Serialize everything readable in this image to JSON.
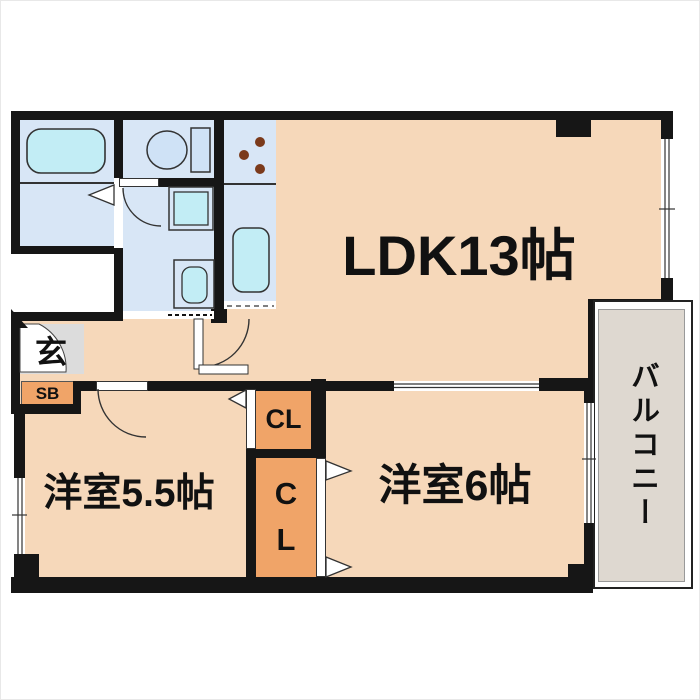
{
  "rooms": {
    "ldk": {
      "label": "LDK13帖"
    },
    "western_room_5_5": {
      "label": "洋室5.5帖"
    },
    "western_room_6": {
      "label": "洋室6帖"
    },
    "balcony": {
      "label": "バルコニー"
    },
    "entrance": {
      "label": "玄"
    },
    "shoe_box": {
      "label": "SB"
    },
    "closet_upper": {
      "label": "CL"
    },
    "closet_lower": {
      "letters": [
        "C",
        "L"
      ]
    }
  },
  "fixtures": [
    "bathtub",
    "toilet",
    "washing-machine",
    "vanity-sink",
    "kitchen-sink",
    "stove-burners"
  ],
  "colors": {
    "wall": "#161616",
    "floor": "#f6d8ba",
    "closet": "#f0a468",
    "room_blue": "#d8e6f6",
    "fixture_cyan": "#c2edf5",
    "fixture_blue": "#cfe2f6",
    "genkan_gray": "#dcdcdc",
    "balcony_gray": "#ded8d0",
    "text": "#111111",
    "stove_dot": "#7b3a1b"
  }
}
